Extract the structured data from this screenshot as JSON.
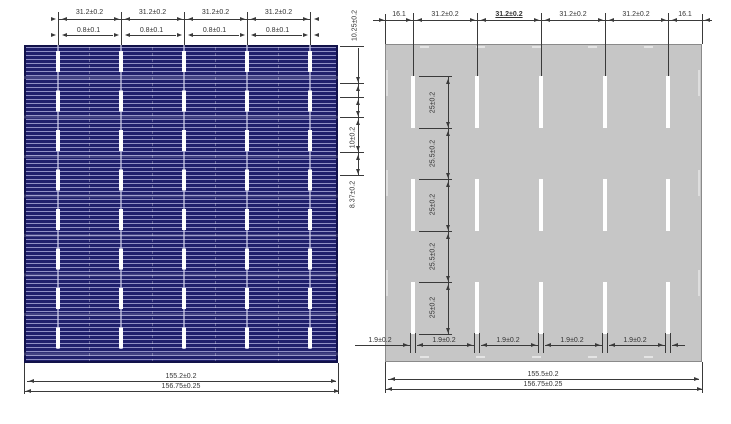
{
  "front": {
    "top_row1": [
      "31.2±0.2",
      "31.2±0.2",
      "31.2±0.2",
      "31.2±0.2"
    ],
    "top_row2": [
      "0.8±0.1",
      "0.8±0.1",
      "0.8±0.1",
      "0.8±0.1"
    ],
    "side": [
      "10.25±0.2",
      "10±0.2",
      "8.37±0.2"
    ],
    "bottom": [
      "155.2±0.2",
      "156.75±0.25"
    ]
  },
  "back": {
    "top": [
      "16.1",
      "31.2±0.2",
      "31.2±0.2",
      "31.2±0.2",
      "31.2±0.2",
      "16.1"
    ],
    "chain": [
      "25±0.2",
      "25.5±0.2",
      "25±0.2",
      "25.5±0.2",
      "25±0.2"
    ],
    "pad_width": [
      "1.9±0.2",
      "1.9±0.2",
      "1.9±0.2",
      "1.9±0.2",
      "1.9±0.2"
    ],
    "bottom": [
      "155.5±0.2",
      "156.75±0.25"
    ]
  },
  "colors": {
    "front_cell": "#20206c",
    "front_finger": "#8f8fc4",
    "busbar_pad": "#ffffff",
    "back_cell": "#c6c6c6",
    "dimension": "#3a3a3a"
  }
}
